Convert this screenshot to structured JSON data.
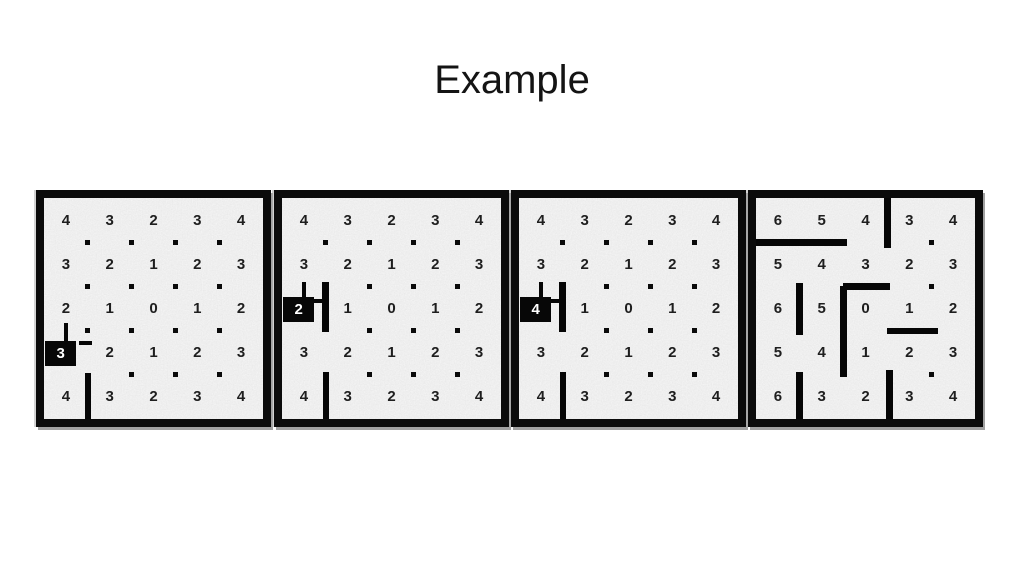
{
  "title": "Example",
  "colors": {
    "background": "#ffffff",
    "title_text": "#141414",
    "panel_border": "#0b0b0b",
    "texture_base": "#d9d9d9",
    "number": "#1e1e1e",
    "wall": "#060606",
    "dot": "#0a0a0a",
    "robot_bg": "#070707",
    "robot_text": "#ffffff",
    "panel_shadow": "#919191"
  },
  "grid": {
    "rows": 5,
    "cols": 5
  },
  "panels": [
    {
      "name": "step-1",
      "values": [
        [
          4,
          3,
          2,
          3,
          4
        ],
        [
          3,
          2,
          1,
          2,
          3
        ],
        [
          2,
          1,
          0,
          1,
          2
        ],
        [
          3,
          2,
          1,
          2,
          3
        ],
        [
          4,
          3,
          2,
          3,
          4
        ]
      ],
      "robot": {
        "row": 3,
        "col": 0,
        "label": "3"
      },
      "walls": [
        {
          "o": "v",
          "x": 0.5,
          "y1": 2.82,
          "y2": 3.3,
          "t": 4
        },
        {
          "o": "h",
          "y": 3.27,
          "x1": 0.8,
          "x2": 1.1,
          "t": 4
        },
        {
          "o": "v",
          "x": 1,
          "y1": 3.95,
          "y2": 5.05,
          "t": 6
        }
      ],
      "dots": [
        [
          1,
          1
        ],
        [
          2,
          1
        ],
        [
          3,
          1
        ],
        [
          4,
          1
        ],
        [
          1,
          2
        ],
        [
          2,
          2
        ],
        [
          3,
          2
        ],
        [
          4,
          2
        ],
        [
          1,
          3
        ],
        [
          2,
          3
        ],
        [
          3,
          3
        ],
        [
          4,
          3
        ],
        [
          2,
          4
        ],
        [
          3,
          4
        ],
        [
          4,
          4
        ]
      ]
    },
    {
      "name": "step-2",
      "values": [
        [
          4,
          3,
          2,
          3,
          4
        ],
        [
          3,
          2,
          1,
          2,
          3
        ],
        [
          2,
          1,
          0,
          1,
          2
        ],
        [
          3,
          2,
          1,
          2,
          3
        ],
        [
          4,
          3,
          2,
          3,
          4
        ]
      ],
      "robot": {
        "row": 2,
        "col": 0,
        "label": "2"
      },
      "walls": [
        {
          "o": "v",
          "x": 0.5,
          "y1": 1.89,
          "y2": 2.28,
          "t": 4
        },
        {
          "o": "h",
          "y": 2.34,
          "x1": 0.72,
          "x2": 1.0,
          "t": 4
        },
        {
          "o": "v",
          "x": 1,
          "y1": 1.9,
          "y2": 3.04,
          "t": 7
        },
        {
          "o": "v",
          "x": 1,
          "y1": 3.94,
          "y2": 5.05,
          "t": 6
        }
      ],
      "dots": [
        [
          1,
          1
        ],
        [
          2,
          1
        ],
        [
          3,
          1
        ],
        [
          4,
          1
        ],
        [
          2,
          2
        ],
        [
          3,
          2
        ],
        [
          4,
          2
        ],
        [
          2,
          3
        ],
        [
          3,
          3
        ],
        [
          4,
          3
        ],
        [
          2,
          4
        ],
        [
          3,
          4
        ],
        [
          4,
          4
        ]
      ]
    },
    {
      "name": "step-3",
      "values": [
        [
          4,
          3,
          2,
          3,
          4
        ],
        [
          3,
          2,
          1,
          2,
          3
        ],
        [
          4,
          1,
          0,
          1,
          2
        ],
        [
          3,
          2,
          1,
          2,
          3
        ],
        [
          4,
          3,
          2,
          3,
          4
        ]
      ],
      "robot": {
        "row": 2,
        "col": 0,
        "label": "4"
      },
      "walls": [
        {
          "o": "v",
          "x": 0.5,
          "y1": 1.89,
          "y2": 2.28,
          "t": 4
        },
        {
          "o": "h",
          "y": 2.34,
          "x1": 0.72,
          "x2": 1.0,
          "t": 4
        },
        {
          "o": "v",
          "x": 1,
          "y1": 1.9,
          "y2": 3.04,
          "t": 7
        },
        {
          "o": "v",
          "x": 1,
          "y1": 3.94,
          "y2": 5.05,
          "t": 6
        }
      ],
      "dots": [
        [
          1,
          1
        ],
        [
          2,
          1
        ],
        [
          3,
          1
        ],
        [
          4,
          1
        ],
        [
          2,
          2
        ],
        [
          3,
          2
        ],
        [
          4,
          2
        ],
        [
          2,
          3
        ],
        [
          3,
          3
        ],
        [
          4,
          3
        ],
        [
          2,
          4
        ],
        [
          3,
          4
        ],
        [
          4,
          4
        ]
      ]
    },
    {
      "name": "step-4",
      "values": [
        [
          6,
          5,
          4,
          3,
          4
        ],
        [
          5,
          4,
          3,
          2,
          3
        ],
        [
          6,
          5,
          0,
          1,
          2
        ],
        [
          5,
          4,
          1,
          2,
          3
        ],
        [
          6,
          3,
          2,
          3,
          4
        ]
      ],
      "robot": null,
      "walls": [
        {
          "o": "h",
          "y": 1,
          "x1": 0,
          "x2": 2.08,
          "t": 7
        },
        {
          "o": "v",
          "x": 3,
          "y1": 0,
          "y2": 1.12,
          "t": 7
        },
        {
          "o": "v",
          "x": 1,
          "y1": 1.93,
          "y2": 3.1,
          "t": 7
        },
        {
          "o": "h",
          "y": 2,
          "x1": 1.98,
          "x2": 3.06,
          "t": 7
        },
        {
          "o": "v",
          "x": 2,
          "y1": 1.98,
          "y2": 4.06,
          "t": 7
        },
        {
          "o": "h",
          "y": 3,
          "x1": 3,
          "x2": 4.16,
          "t": 6
        },
        {
          "o": "v",
          "x": 1,
          "y1": 3.93,
          "y2": 5.05,
          "t": 7
        },
        {
          "o": "v",
          "x": 3.05,
          "y1": 3.9,
          "y2": 5.05,
          "t": 7
        }
      ],
      "dots": [
        [
          4,
          1
        ],
        [
          4,
          2
        ],
        [
          4,
          4
        ]
      ]
    }
  ]
}
